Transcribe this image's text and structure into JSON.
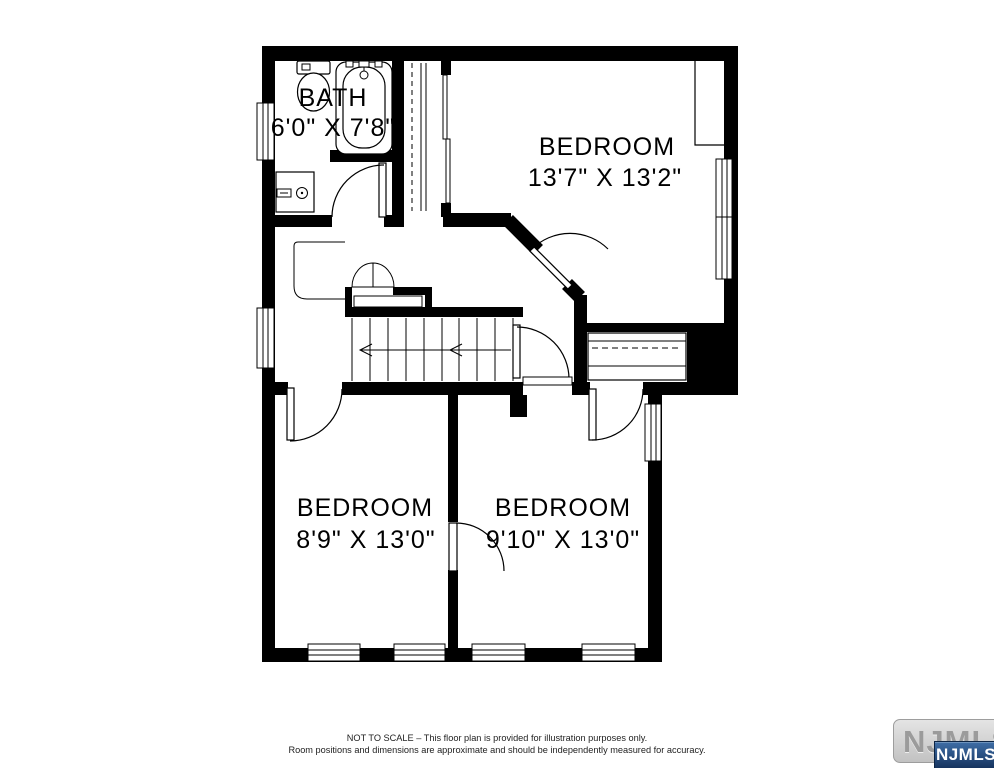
{
  "rooms": {
    "bath": {
      "name": "BATH",
      "dims": "6'0\" X 7'8\""
    },
    "bedroom_top": {
      "name": "BEDROOM",
      "dims": "13'7\" X 13'2\""
    },
    "bedroom_left": {
      "name": "BEDROOM",
      "dims": "8'9\" X 13'0\""
    },
    "bedroom_right": {
      "name": "BEDROOM",
      "dims": "9'10\" X 13'0\""
    }
  },
  "fixtures": [
    "toilet",
    "bathtub",
    "sink-vanity",
    "staircase-down-arrow",
    "bifold-closet-doors",
    "closet-hanging-rod"
  ],
  "disclaimer": {
    "line1": "NOT TO SCALE – This floor plan is provided for illustration purposes only.",
    "line2": "Room positions and dimensions are approximate and should be independently measured for accuracy."
  },
  "watermark": {
    "background_text": "NJMLS",
    "badge_text": "NJMLS"
  },
  "colors": {
    "wall": "#000000",
    "background": "#ffffff",
    "badge_blue_top": "#3f6ea6",
    "badge_blue_bottom": "#16345f",
    "watermark_gray": "#9b9b9b"
  }
}
